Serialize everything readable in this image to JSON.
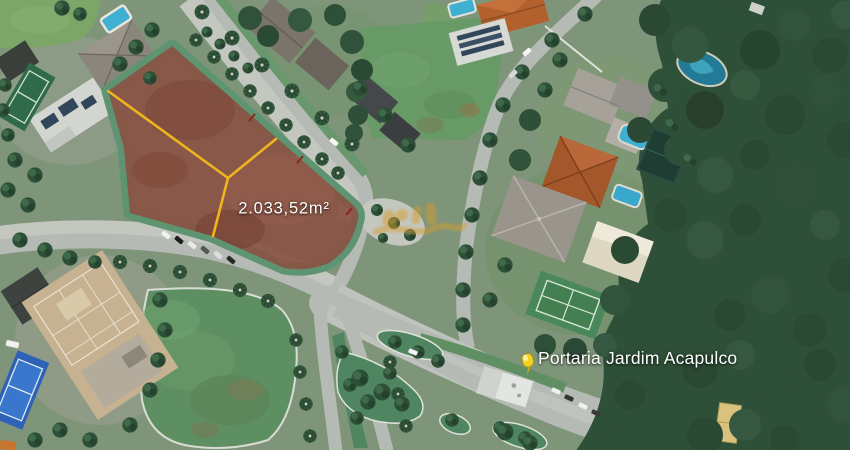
{
  "map": {
    "type": "satellite-aerial-view",
    "lot": {
      "area_label": "2.033,52m²"
    },
    "poi": {
      "label": "Portaria Jardim Acapulco"
    }
  },
  "colors": {
    "lot_fill": "#8a5243",
    "lot_divider_yellow": "#f0b41e",
    "verge_green": "#5e9471",
    "road_gray": "#b6bab4",
    "pin_yellow": "#f2d024",
    "label_text": "#ffffff",
    "watermark_gold": "#d89b2a"
  }
}
